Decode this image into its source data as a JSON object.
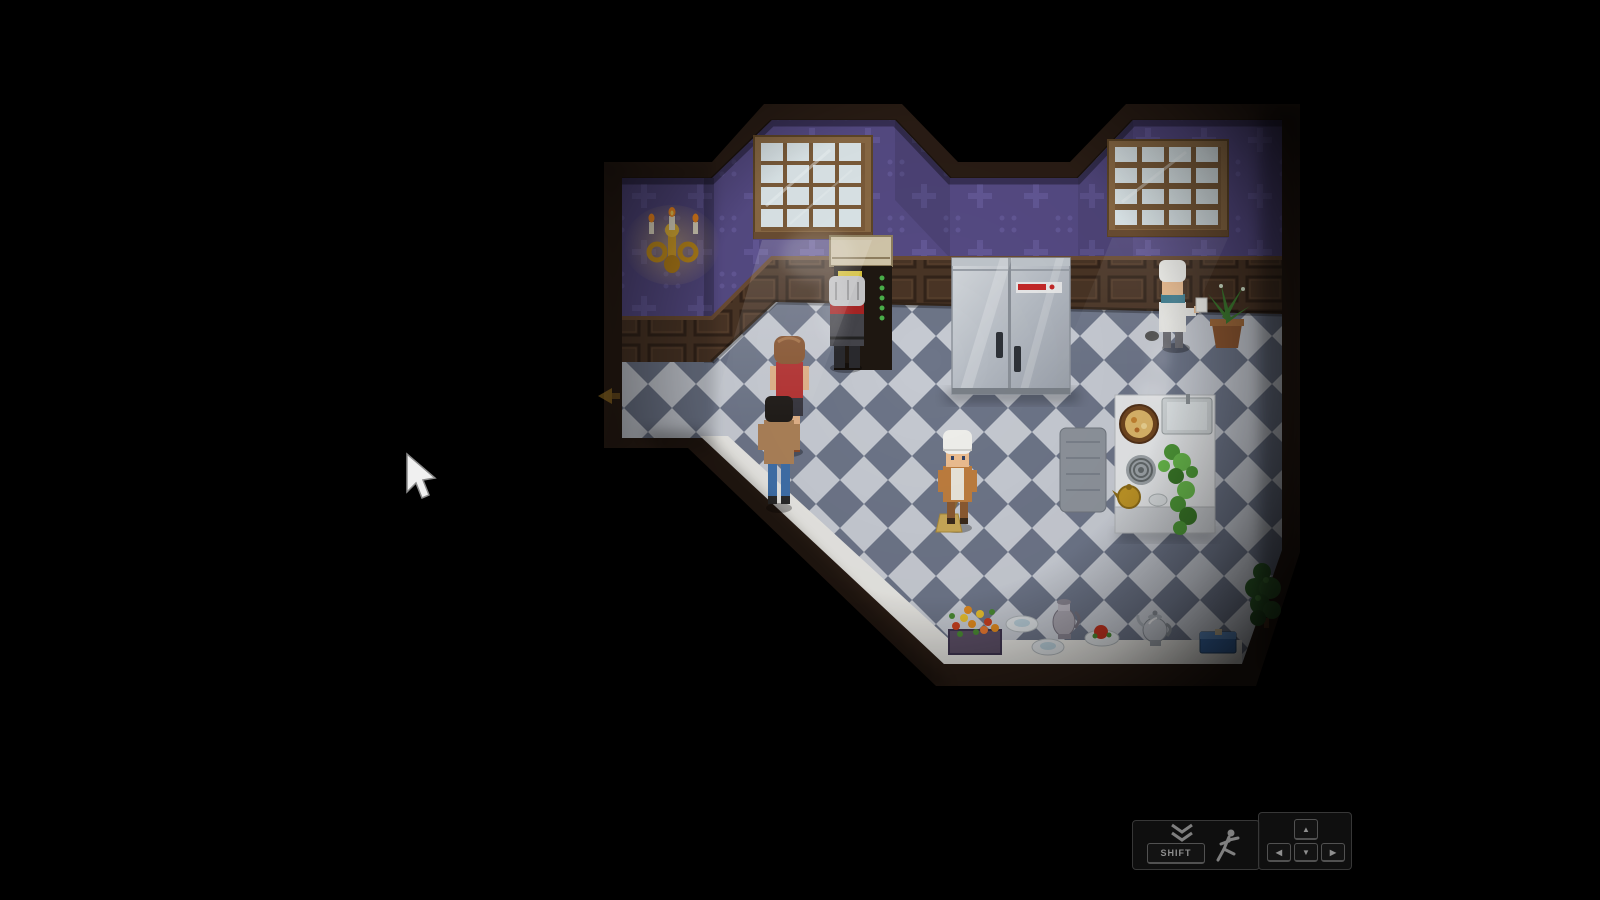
{
  "hud": {
    "dash_panel": {
      "key_label": "SHIFT",
      "chevron_icon": "double-chevron-down",
      "runner_icon": "running-person"
    },
    "move_panel": {
      "up_key": "▲",
      "left_key": "◀",
      "down_key": "▼",
      "right_key": "▶"
    }
  },
  "palette": {
    "background": "#000000",
    "wallpaper": "#564b84",
    "wallpaper_motif": "#6c61a4",
    "wainscot_wood": "#4a3526",
    "trim_wood": "#2a1d15",
    "floor_light": "#c6cad2",
    "floor_dark": "#6d7588",
    "walkway_white": "#e7e6e2",
    "fridge_steel": "#c0c6cc",
    "window_pane": "#dde7ea",
    "sconce_gold": "#d8a22a",
    "poster_yellow": "#d9c33c",
    "fridge_label_red": "#c42828"
  }
}
